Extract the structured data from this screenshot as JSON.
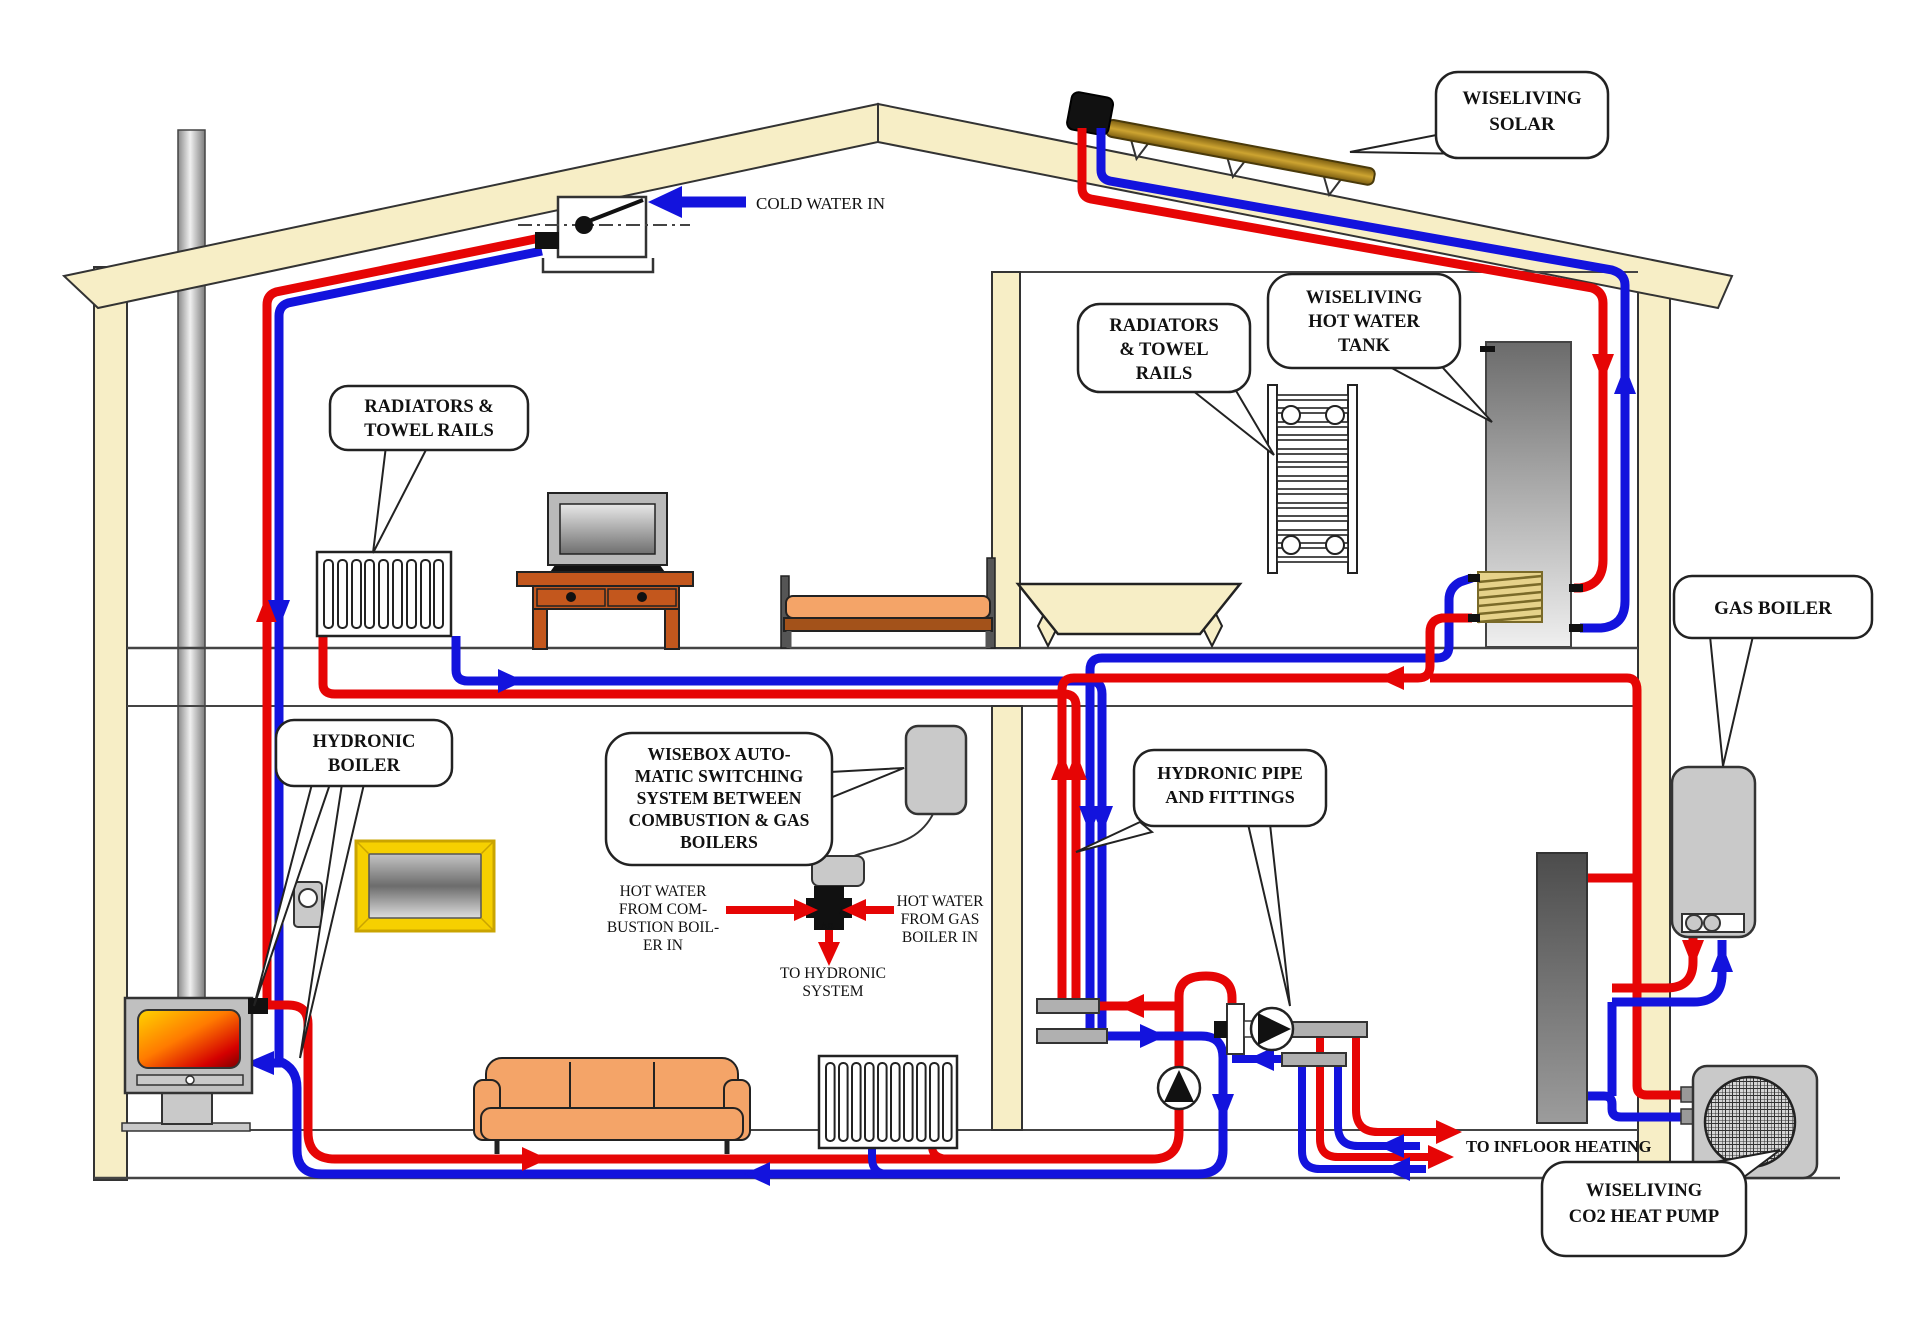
{
  "title": "Wiseliving combined heating system house diagram",
  "colors": {
    "hot_pipe": "#e60505",
    "cold_pipe": "#1313dd",
    "wall_beige": "#f7eec6",
    "equipment_gray": "#c9c9c9",
    "solar_gold": "#b8860b",
    "fire_orange": "#ff7a00",
    "frame_yellow": "#f6d000"
  },
  "callouts": {
    "solar": {
      "lines": [
        "WISELIVING",
        "SOLAR"
      ]
    },
    "radiators_left": {
      "lines": [
        "RADIATORS &",
        "TOWEL RAILS"
      ]
    },
    "radiators_right": {
      "lines": [
        "RADIATORS",
        "& TOWEL",
        "RAILS"
      ]
    },
    "hot_water_tank": {
      "lines": [
        "WISELIVING",
        "HOT WATER",
        "TANK"
      ]
    },
    "gas_boiler": {
      "lines": [
        "GAS BOILER"
      ]
    },
    "hydronic_boiler": {
      "lines": [
        "HYDRONIC",
        "BOILER"
      ]
    },
    "wisebox": {
      "lines": [
        "WISEBOX AUTO-",
        "MATIC SWITCHING",
        "SYSTEM BETWEEN",
        "COMBUSTION & GAS",
        "BOILERS"
      ]
    },
    "hydronic_pipe": {
      "lines": [
        "HYDRONIC PIPE",
        "AND FITTINGS"
      ]
    },
    "co2_heat_pump": {
      "lines": [
        "WISELIVING",
        "CO2 HEAT PUMP"
      ]
    }
  },
  "labels": {
    "cold_water_in": "COLD WATER IN",
    "to_infloor": "TO INFLOOR HEATING",
    "hw_combustion": {
      "lines": [
        "HOT WATER",
        "FROM  COM-",
        "BUSTION BOIL-",
        "ER  IN"
      ]
    },
    "hw_gas": {
      "lines": [
        "HOT WATER",
        "FROM GAS",
        "BOILER IN"
      ]
    },
    "to_hydronic": {
      "lines": [
        "TO HYDRONIC",
        "SYSTEM"
      ]
    },
    "valve_ports": {
      "left": "B",
      "right": "A",
      "bottom": "AB"
    }
  }
}
